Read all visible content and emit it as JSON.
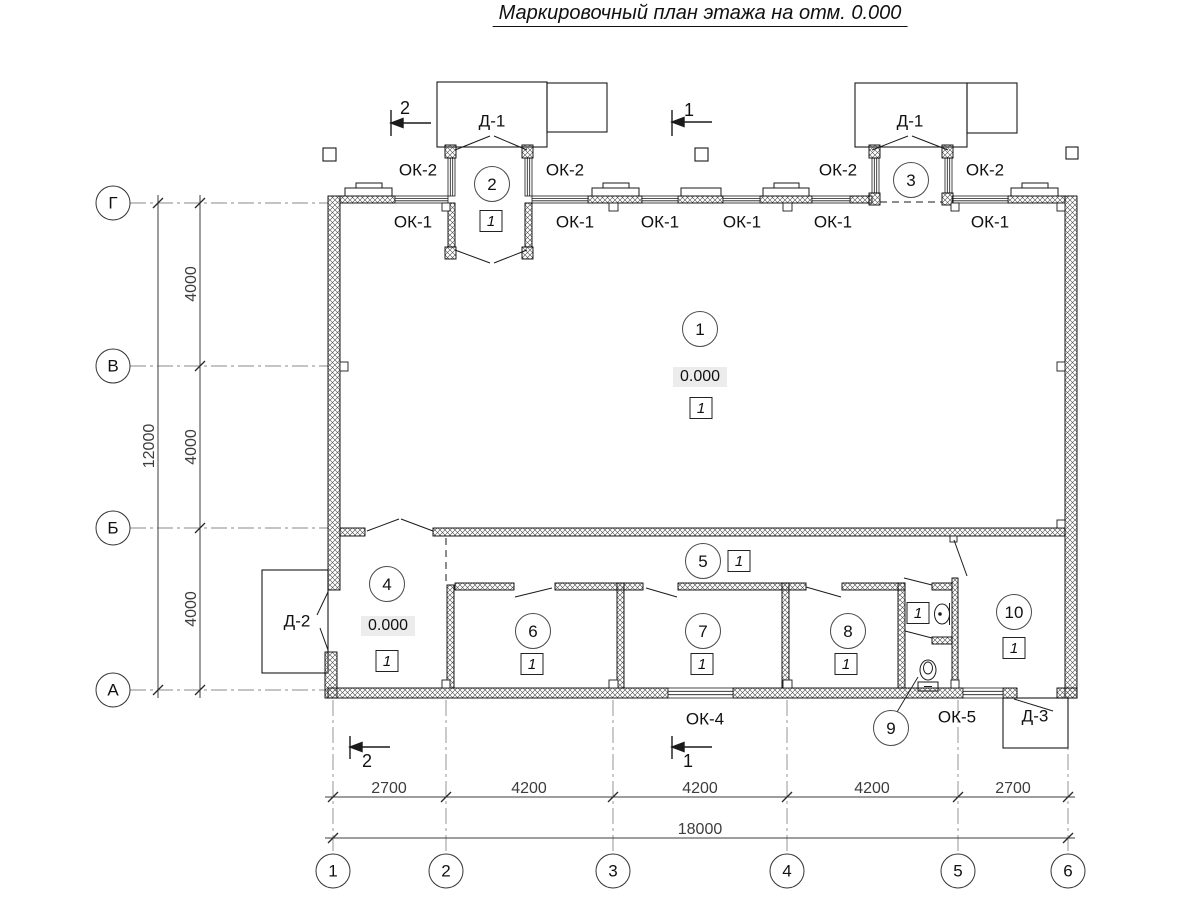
{
  "title": "Маркировочный план этажа на отм. 0.000",
  "colors": {
    "line": "#1a1a1a",
    "dim_line": "#3d3d3d",
    "axis_line": "#8a8a8a",
    "elev_bg": "#ececec",
    "paper": "#ffffff"
  },
  "axes": {
    "letters": [
      "Г",
      "В",
      "Б",
      "А"
    ],
    "numbers": [
      "1",
      "2",
      "3",
      "4",
      "5",
      "6"
    ],
    "letter_spacing_mm": [
      4000,
      4000,
      4000
    ],
    "total_vertical_mm": 12000,
    "number_spacing_mm": [
      2700,
      4200,
      4200,
      4200,
      2700
    ],
    "total_horizontal_mm": 18000
  },
  "marks": {
    "windows": [
      "ОК-1",
      "ОК-2",
      "ОК-4",
      "ОК-5"
    ],
    "doors": [
      "Д-1",
      "Д-2",
      "Д-3"
    ],
    "rooms": [
      "1",
      "2",
      "3",
      "4",
      "5",
      "6",
      "7",
      "8",
      "9",
      "10"
    ],
    "floor_type": "1",
    "elevation": "0.000",
    "sections": [
      "1",
      "2"
    ]
  },
  "labels": [
    {
      "name": "axis-letter-g",
      "cls": "axis-circle",
      "text": "Г",
      "x": 113,
      "y": 203
    },
    {
      "name": "axis-letter-v",
      "cls": "axis-circle",
      "text": "В",
      "x": 113,
      "y": 366
    },
    {
      "name": "axis-letter-b",
      "cls": "axis-circle",
      "text": "Б",
      "x": 113,
      "y": 528
    },
    {
      "name": "axis-letter-a",
      "cls": "axis-circle",
      "text": "А",
      "x": 113,
      "y": 690
    },
    {
      "name": "axis-number-1",
      "cls": "axis-circle",
      "text": "1",
      "x": 333,
      "y": 871
    },
    {
      "name": "axis-number-2",
      "cls": "axis-circle",
      "text": "2",
      "x": 446,
      "y": 871
    },
    {
      "name": "axis-number-3",
      "cls": "axis-circle",
      "text": "3",
      "x": 613,
      "y": 871
    },
    {
      "name": "axis-number-4",
      "cls": "axis-circle",
      "text": "4",
      "x": 787,
      "y": 871
    },
    {
      "name": "axis-number-5",
      "cls": "axis-circle",
      "text": "5",
      "x": 958,
      "y": 871
    },
    {
      "name": "axis-number-6",
      "cls": "axis-circle",
      "text": "6",
      "x": 1068,
      "y": 871
    },
    {
      "name": "room-circle-1",
      "cls": "room-circle",
      "text": "1",
      "x": 700,
      "y": 329
    },
    {
      "name": "room-circle-2",
      "cls": "room-circle",
      "text": "2",
      "x": 492,
      "y": 184
    },
    {
      "name": "room-circle-3",
      "cls": "room-circle",
      "text": "3",
      "x": 911,
      "y": 180
    },
    {
      "name": "room-circle-4",
      "cls": "room-circle",
      "text": "4",
      "x": 387,
      "y": 584
    },
    {
      "name": "room-circle-5",
      "cls": "room-circle",
      "text": "5",
      "x": 703,
      "y": 561
    },
    {
      "name": "room-circle-6",
      "cls": "room-circle",
      "text": "6",
      "x": 533,
      "y": 631
    },
    {
      "name": "room-circle-7",
      "cls": "room-circle",
      "text": "7",
      "x": 703,
      "y": 631
    },
    {
      "name": "room-circle-8",
      "cls": "room-circle",
      "text": "8",
      "x": 848,
      "y": 631
    },
    {
      "name": "room-circle-9",
      "cls": "room-circle",
      "text": "9",
      "x": 891,
      "y": 728
    },
    {
      "name": "room-circle-10",
      "cls": "room-circle",
      "text": "10",
      "x": 1014,
      "y": 612
    },
    {
      "name": "floor-box-room1",
      "cls": "box",
      "text": "1",
      "x": 701,
      "y": 408
    },
    {
      "name": "floor-box-room2",
      "cls": "box",
      "text": "1",
      "x": 491,
      "y": 221
    },
    {
      "name": "floor-box-room4",
      "cls": "box",
      "text": "1",
      "x": 387,
      "y": 661
    },
    {
      "name": "floor-box-room5",
      "cls": "box",
      "text": "1",
      "x": 739,
      "y": 561
    },
    {
      "name": "floor-box-room6",
      "cls": "box",
      "text": "1",
      "x": 532,
      "y": 664
    },
    {
      "name": "floor-box-room7",
      "cls": "box",
      "text": "1",
      "x": 702,
      "y": 664
    },
    {
      "name": "floor-box-room8",
      "cls": "box",
      "text": "1",
      "x": 846,
      "y": 664
    },
    {
      "name": "floor-box-washroom",
      "cls": "box",
      "text": "1",
      "x": 918,
      "y": 613
    },
    {
      "name": "floor-box-room10",
      "cls": "box",
      "text": "1",
      "x": 1014,
      "y": 648
    },
    {
      "name": "elevation-room1",
      "cls": "elev",
      "text": "0.000",
      "x": 700,
      "y": 377
    },
    {
      "name": "elevation-room4",
      "cls": "elev",
      "text": "0.000",
      "x": 388,
      "y": 626
    },
    {
      "name": "window-label-ok1-1",
      "cls": "lbl",
      "text": "ОК-1",
      "x": 413,
      "y": 222
    },
    {
      "name": "window-label-ok1-2",
      "cls": "lbl",
      "text": "ОК-1",
      "x": 575,
      "y": 222
    },
    {
      "name": "window-label-ok1-3",
      "cls": "lbl",
      "text": "ОК-1",
      "x": 660,
      "y": 222
    },
    {
      "name": "window-label-ok1-4",
      "cls": "lbl",
      "text": "ОК-1",
      "x": 742,
      "y": 222
    },
    {
      "name": "window-label-ok1-5",
      "cls": "lbl",
      "text": "ОК-1",
      "x": 833,
      "y": 222
    },
    {
      "name": "window-label-ok1-6",
      "cls": "lbl",
      "text": "ОК-1",
      "x": 990,
      "y": 222
    },
    {
      "name": "window-label-ok2-1",
      "cls": "lbl",
      "text": "ОК-2",
      "x": 418,
      "y": 170
    },
    {
      "name": "window-label-ok2-2",
      "cls": "lbl",
      "text": "ОК-2",
      "x": 565,
      "y": 170
    },
    {
      "name": "window-label-ok2-3",
      "cls": "lbl",
      "text": "ОК-2",
      "x": 838,
      "y": 170
    },
    {
      "name": "window-label-ok2-4",
      "cls": "lbl",
      "text": "ОК-2",
      "x": 985,
      "y": 170
    },
    {
      "name": "window-label-ok4",
      "cls": "lbl",
      "text": "ОК-4",
      "x": 705,
      "y": 719
    },
    {
      "name": "window-label-ok5",
      "cls": "lbl",
      "text": "ОК-5",
      "x": 957,
      "y": 717
    },
    {
      "name": "door-label-d1-left",
      "cls": "lbl",
      "text": "Д-1",
      "x": 492,
      "y": 121
    },
    {
      "name": "door-label-d1-right",
      "cls": "lbl",
      "text": "Д-1",
      "x": 910,
      "y": 121
    },
    {
      "name": "door-label-d2",
      "cls": "lbl",
      "text": "Д-2",
      "x": 297,
      "y": 621
    },
    {
      "name": "door-label-d3",
      "cls": "lbl",
      "text": "Д-3",
      "x": 1035,
      "y": 716
    },
    {
      "name": "section-mark-2-top",
      "cls": "sec",
      "text": "2",
      "x": 405,
      "y": 108
    },
    {
      "name": "section-mark-1-top",
      "cls": "sec",
      "text": "1",
      "x": 689,
      "y": 110
    },
    {
      "name": "section-mark-2-bottom",
      "cls": "sec",
      "text": "2",
      "x": 367,
      "y": 761
    },
    {
      "name": "section-mark-1-bottom",
      "cls": "sec",
      "text": "1",
      "x": 688,
      "y": 761
    },
    {
      "name": "dim-4000-top",
      "cls": "dimv",
      "text": "4000",
      "x": 192,
      "y": 284
    },
    {
      "name": "dim-4000-mid",
      "cls": "dimv",
      "text": "4000",
      "x": 192,
      "y": 447
    },
    {
      "name": "dim-4000-bottom",
      "cls": "dimv",
      "text": "4000",
      "x": 192,
      "y": 609
    },
    {
      "name": "dim-12000",
      "cls": "dimv",
      "text": "12000",
      "x": 150,
      "y": 446
    },
    {
      "name": "dim-2700-left",
      "cls": "dim",
      "text": "2700",
      "x": 389,
      "y": 789
    },
    {
      "name": "dim-4200-1",
      "cls": "dim",
      "text": "4200",
      "x": 529,
      "y": 789
    },
    {
      "name": "dim-4200-2",
      "cls": "dim",
      "text": "4200",
      "x": 700,
      "y": 789
    },
    {
      "name": "dim-4200-3",
      "cls": "dim",
      "text": "4200",
      "x": 872,
      "y": 789
    },
    {
      "name": "dim-2700-right",
      "cls": "dim",
      "text": "2700",
      "x": 1013,
      "y": 789
    },
    {
      "name": "dim-18000",
      "cls": "dim",
      "text": "18000",
      "x": 700,
      "y": 830
    }
  ]
}
